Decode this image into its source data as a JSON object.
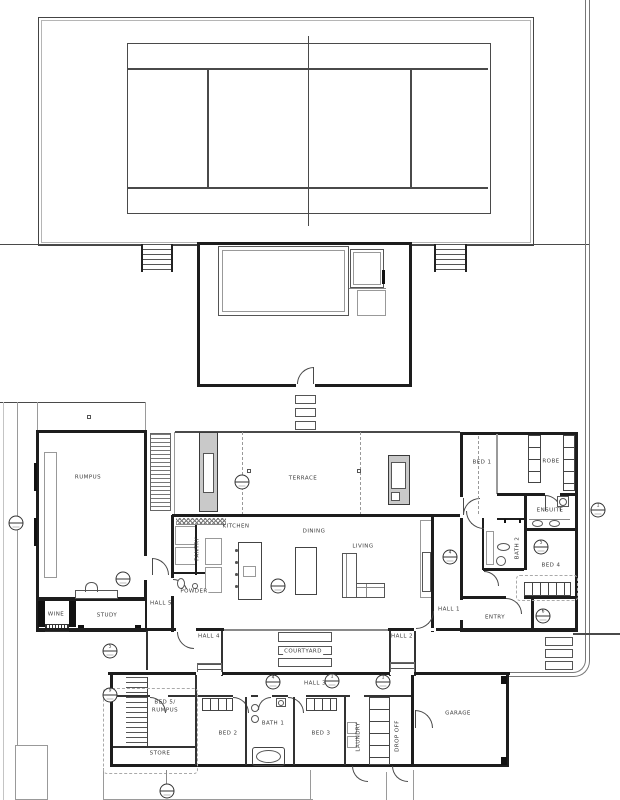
{
  "rooms": {
    "rumpus": "RUMPUS",
    "wine": "WINE",
    "study": "STUDY",
    "kitchen": "KITCHEN",
    "pantry": "PANTRY",
    "powder": "POWDER",
    "terrace": "TERRACE",
    "dining": "DINING",
    "living": "LIVING",
    "bed1": "BED 1",
    "robe": "ROBE",
    "ensuite": "ENSUITE",
    "bath2": "BATH 2",
    "bed4": "BED 4",
    "entry": "ENTRY",
    "courtyard": "COURTYARD",
    "bed5_line1": "BED 5/",
    "bed5_line2": "RUMPUS",
    "store": "STORE",
    "bed2": "BED 2",
    "bath1": "BATH 1",
    "bed3": "BED 3",
    "laundry": "LAUNDRY",
    "drop_off": "DROP OFF",
    "garage": "GARAGE"
  },
  "halls": {
    "hall1": "HALL 1",
    "hall2": "HALL 2",
    "hall3": "HALL 3",
    "hall4": "HALL 4",
    "hall5": "HALL 5"
  },
  "markers": [
    {
      "num": ""
    },
    {
      "num": ""
    },
    {
      "num": ""
    },
    {
      "num": "4"
    },
    {
      "num": "5"
    },
    {
      "num": "6"
    },
    {
      "num": "1"
    },
    {
      "num": "5"
    },
    {
      "num": "9"
    },
    {
      "num": "4"
    },
    {
      "num": "1"
    },
    {
      "num": "1"
    },
    {
      "num": ""
    }
  ],
  "colors": {
    "wall": "#1d1d1d",
    "line": "#4a4a4a",
    "light": "#9a9a9a",
    "label": "#3a3a3a"
  }
}
